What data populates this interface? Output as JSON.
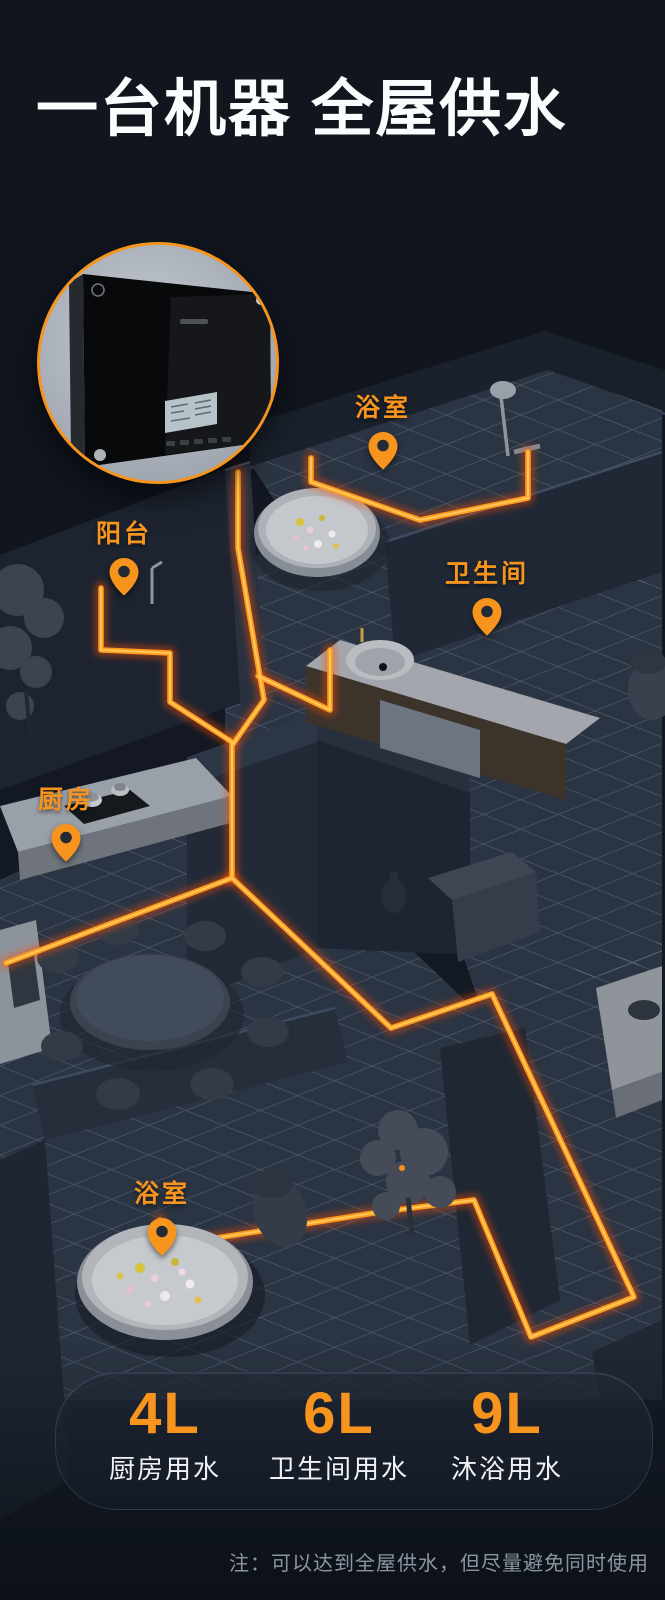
{
  "header": {
    "title": "一台机器 全屋供水"
  },
  "inset": {
    "image_name": "black-wall-hung-water-heater",
    "ring_color": "#F7941E"
  },
  "map": {
    "markers": [
      {
        "id": "bathroom-top",
        "label": "浴室"
      },
      {
        "id": "balcony",
        "label": "阳台"
      },
      {
        "id": "toilet-room",
        "label": "卫生间"
      },
      {
        "id": "kitchen",
        "label": "厨房"
      },
      {
        "id": "bathroom-bottom",
        "label": "浴室"
      }
    ]
  },
  "stats": {
    "items": [
      {
        "value": "4L",
        "label": "厨房用水"
      },
      {
        "value": "6L",
        "label": "卫生间用水"
      },
      {
        "value": "9L",
        "label": "沐浴用水"
      }
    ]
  },
  "footnote": {
    "text": "注：可以达到全屋供水，但尽量避免同时使用"
  },
  "colors": {
    "accent": "#F7941E",
    "pipe": "#FF9D1E",
    "pipe_glow": "#FF4D00",
    "background": "#0E141C",
    "text_primary": "#FAFCFE",
    "text_muted": "#8B95A1"
  }
}
